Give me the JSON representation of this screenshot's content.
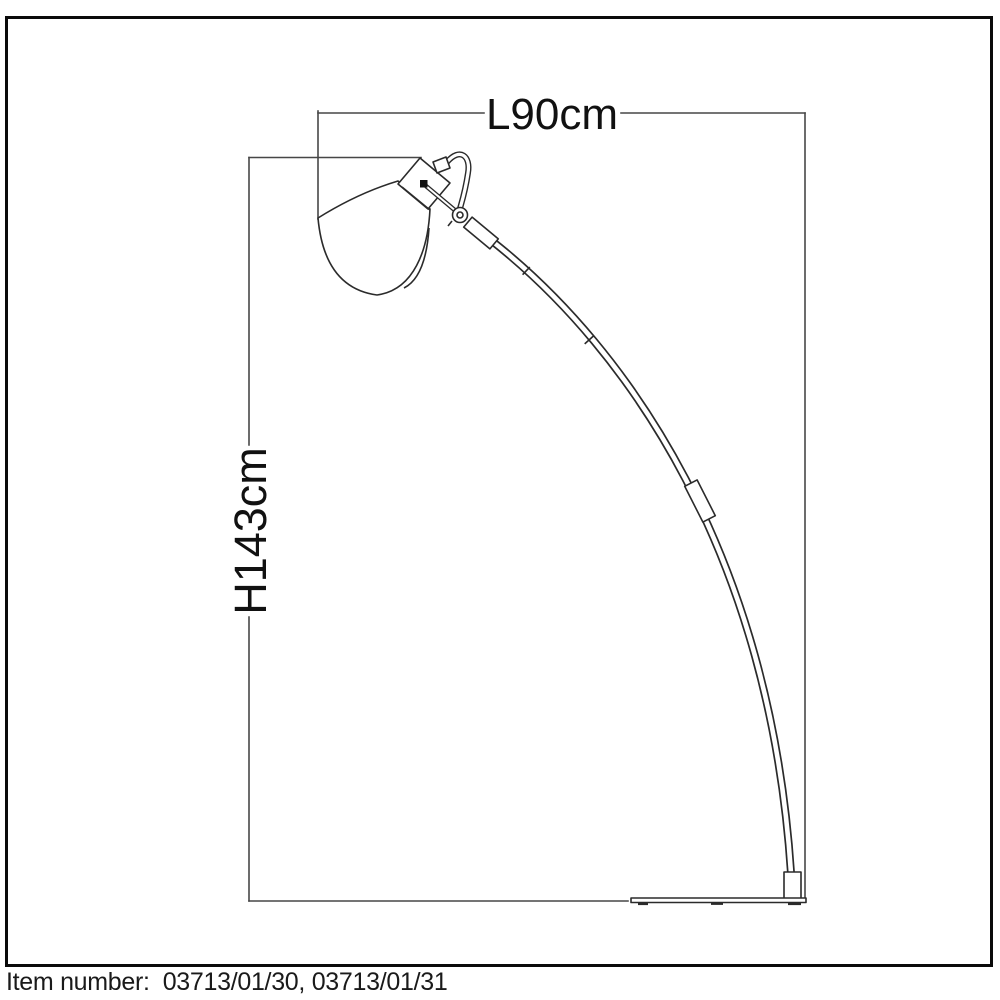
{
  "colors": {
    "background": "#ffffff",
    "frame_border": "#0a0a0a",
    "drawing_line": "#2b2b2b",
    "dimension_line": "#474747",
    "label_text": "#111111",
    "footer_text": "#1a1a1a"
  },
  "dimensions": {
    "length": {
      "label": "L90cm"
    },
    "height": {
      "label": "H143cm"
    }
  },
  "footer": {
    "label": "Item number:",
    "value": "03713/01/30, 03713/01/31"
  }
}
